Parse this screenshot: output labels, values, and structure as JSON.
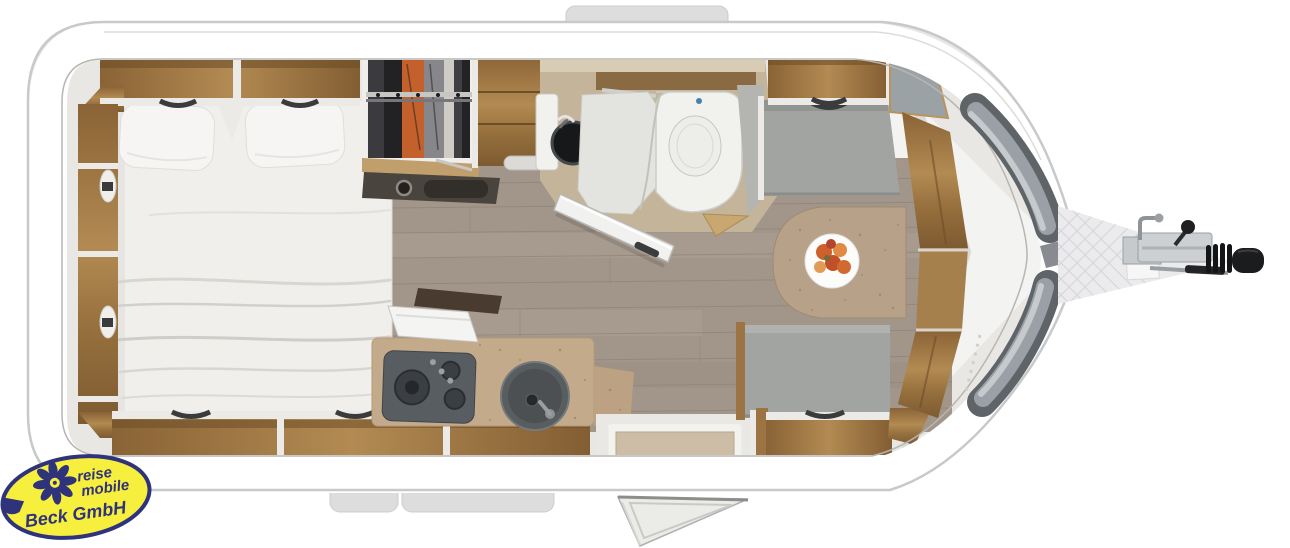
{
  "image": {
    "title": "Caravan floor plan (top view)",
    "dealer_logo": {
      "line1": "reise",
      "line2": "mobile",
      "line3": "Beck GmbH"
    }
  },
  "colors": {
    "logo_yellow": "#f7ef3e",
    "logo_blue": "#2f337c",
    "body_white": "#ffffff",
    "outline_gray": "#c7c9ca",
    "wood_cabinet": "#9c7443",
    "floor_plank": "#a2958a",
    "seat_gray": "#a2a4a1",
    "front_window_gray": "#5f6468",
    "kitchen_counter_cork": "#c3aa8b",
    "wardrobe_clothes_orange": "#c4602c",
    "hitch_black": "#1b1c1e"
  },
  "icons": {
    "logo_flower": "sunflower-icon"
  }
}
